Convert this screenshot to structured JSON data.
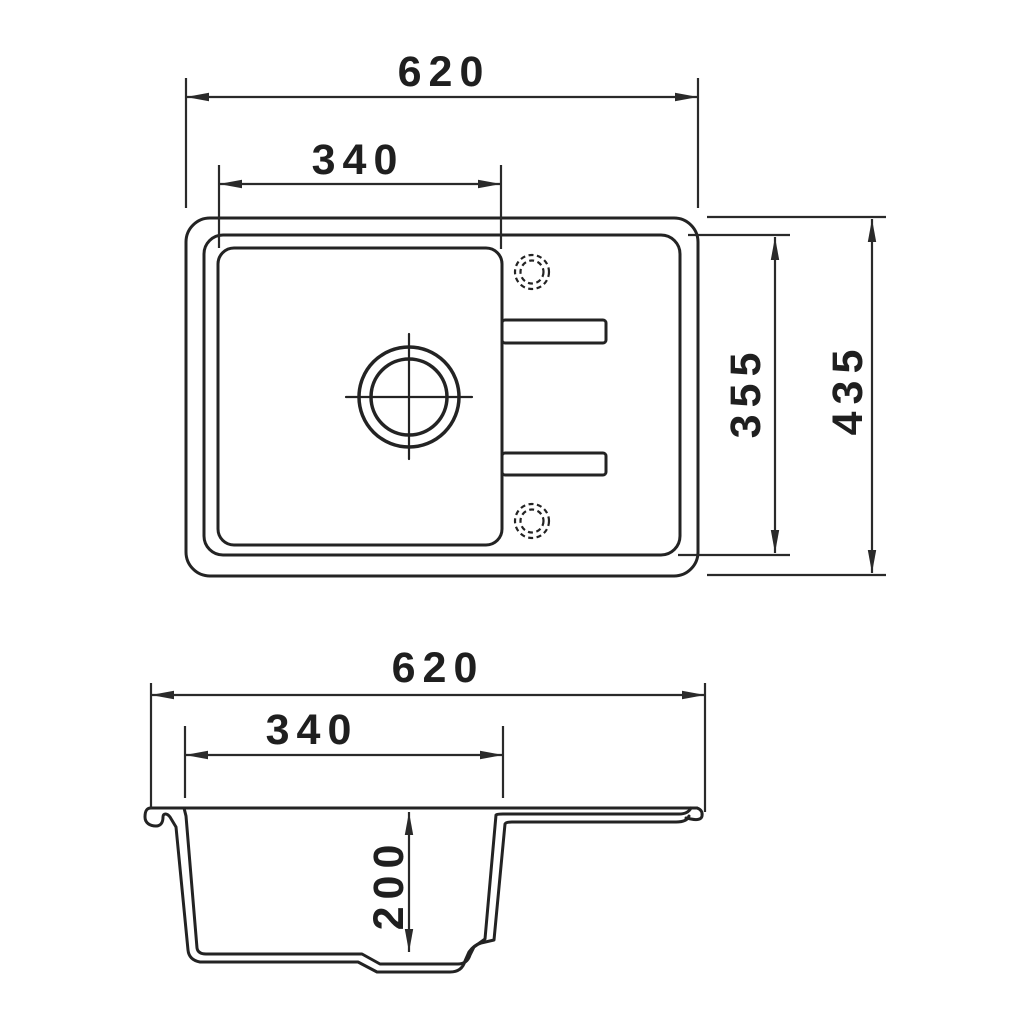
{
  "drawing": {
    "labels": {
      "top_width": "620",
      "top_bowl_width": "340",
      "top_inner_depth": "355",
      "top_outer_depth": "435",
      "side_width": "620",
      "side_bowl_width": "340",
      "side_bowl_depth": "200"
    },
    "colors": {
      "line": "#232323",
      "dimension_line": "#2a2a2a",
      "text": "#1f1f1f",
      "background": "#ffffff"
    }
  }
}
